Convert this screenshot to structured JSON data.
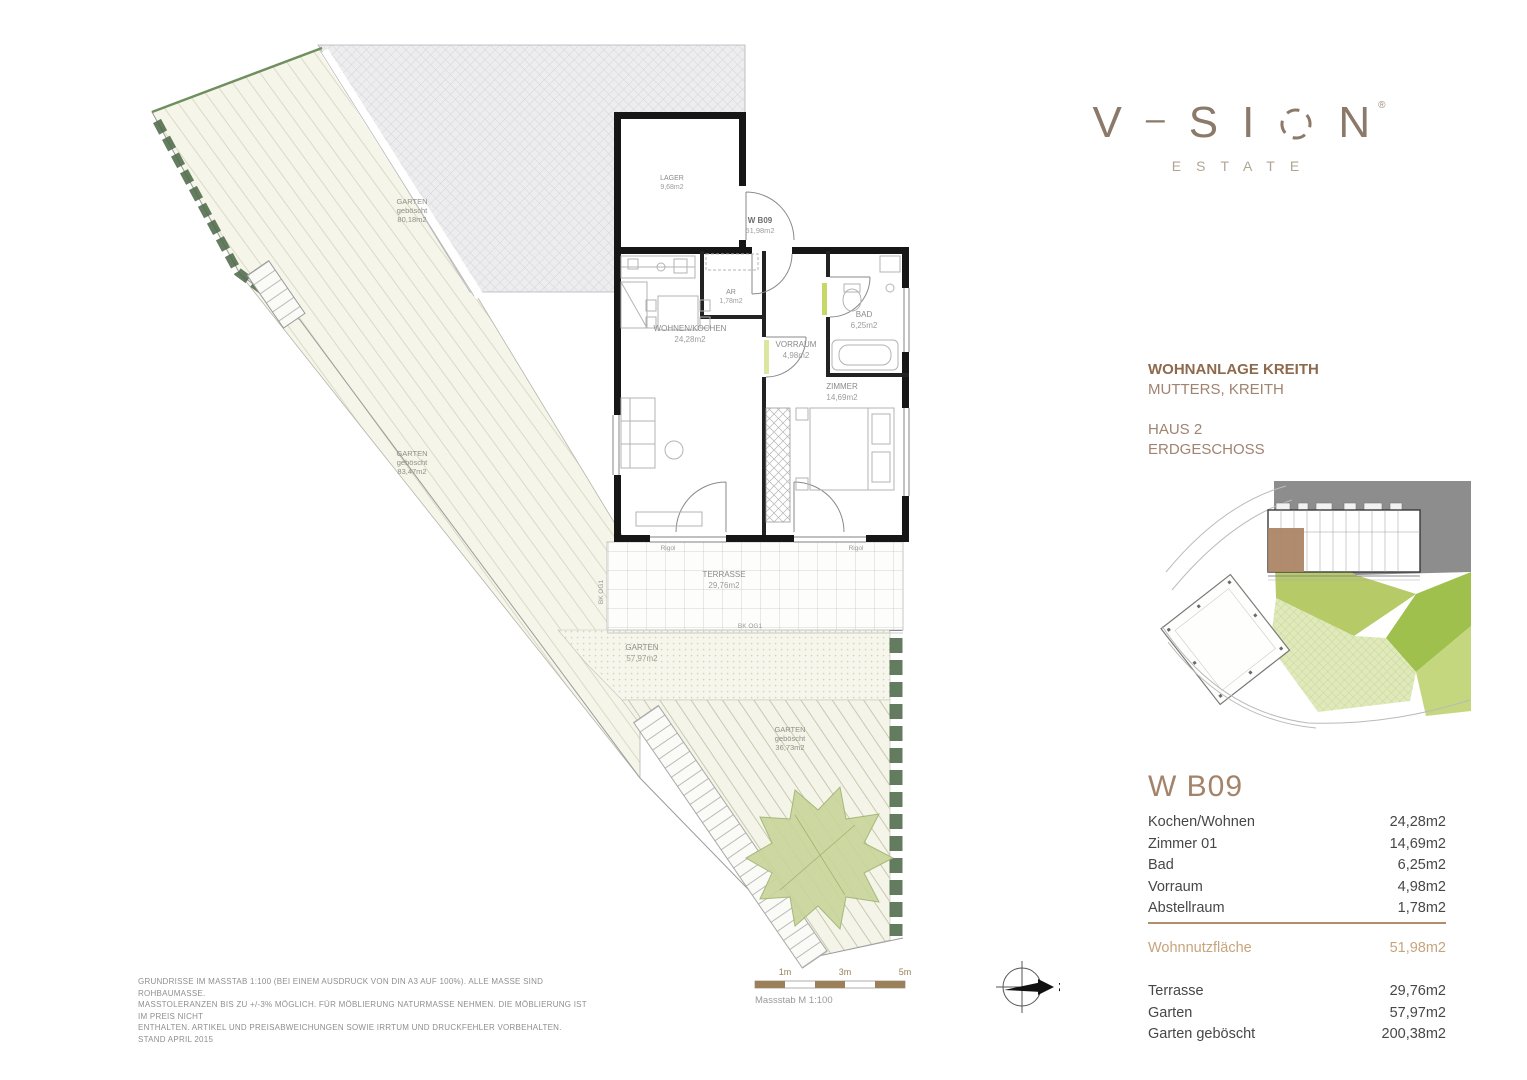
{
  "logo": {
    "v": "V",
    "dash": "–",
    "s": "S",
    "i": "I",
    "n": "N",
    "reg": "®",
    "estate": "ESTATE"
  },
  "project": {
    "title": "WOHNANLAGE KREITH",
    "location": "MUTTERS, KREITH",
    "house": "HAUS 2",
    "floor": "ERDGESCHOSS"
  },
  "unit": {
    "id": "W B09",
    "rooms": [
      {
        "label": "Kochen/Wohnen",
        "area": "24,28m2"
      },
      {
        "label": "Zimmer 01",
        "area": "14,69m2"
      },
      {
        "label": "Bad",
        "area": "6,25m2"
      },
      {
        "label": "Vorraum",
        "area": "4,98m2"
      },
      {
        "label": "Abstellraum",
        "area": "1,78m2"
      }
    ],
    "total": {
      "label": "Wohnnutzfläche",
      "area": "51,98m2"
    },
    "outdoor": [
      {
        "label": "Terrasse",
        "area": "29,76m2"
      },
      {
        "label": "Garten",
        "area": "57,97m2"
      },
      {
        "label": "Garten geböscht",
        "area": "200,38m2"
      }
    ]
  },
  "plan": {
    "lager": {
      "name": "LAGER",
      "area": "9,68m2"
    },
    "unit_tag": {
      "name": "W B09",
      "area": "51,98m2"
    },
    "rooms": {
      "ar": {
        "name": "AR",
        "area": "1,78m2"
      },
      "wohnen": {
        "name": "WOHNEN/KOCHEN",
        "area": "24,28m2"
      },
      "vorraum": {
        "name": "VORRAUM",
        "area": "4,98m2"
      },
      "bad": {
        "name": "BAD",
        "area": "6,25m2"
      },
      "zimmer": {
        "name": "ZIMMER",
        "area": "14,69m2"
      }
    },
    "outdoor": {
      "terrasse": {
        "name": "TERRASSE",
        "area": "29,76m2"
      },
      "garten": {
        "name": "GARTEN",
        "area": "57,97m2"
      },
      "boeschung1": {
        "name": "GARTEN",
        "sub": "geböscht",
        "area": "80,18m2"
      },
      "boeschung2": {
        "name": "GARTEN",
        "sub": "geböscht",
        "area": "83,47m2"
      },
      "boeschung3": {
        "name": "GARTEN",
        "sub": "geböscht",
        "area": "36,73m2"
      }
    },
    "annotations": {
      "rigol": "Rigol",
      "bk": "BK OG1"
    }
  },
  "footer": {
    "disclaimer_lines": [
      "GRUNDRISSE IM MASSTAB 1:100 (BEI EINEM AUSDRUCK VON DIN A3 AUF 100%). ALLE MASSE SIND ROHBAUMASSE.",
      "MASSTOLERANZEN BIS ZU +/-3% MÖGLICH. FÜR MÖBLIERUNG NATURMASSE NEHMEN. DIE MÖBLIERUNG IST IM PREIS NICHT",
      "ENTHALTEN. ARTIKEL UND PREISABWEICHUNGEN SOWIE IRRTUM UND DRUCKFEHLER VORBEHALTEN. STAND APRIL 2015"
    ],
    "scale_ticks": [
      "1m",
      "3m",
      "5m"
    ],
    "scale_label": "Massstab M 1:100",
    "north_letter": "N"
  },
  "colors": {
    "brand": "#8b7969",
    "heading_brown": "#8d6a4d",
    "accent_tan": "#c7a47c",
    "hedge_green": "#4e6b4a",
    "tree_green": "#c9d59b",
    "wall_black": "#161616"
  }
}
